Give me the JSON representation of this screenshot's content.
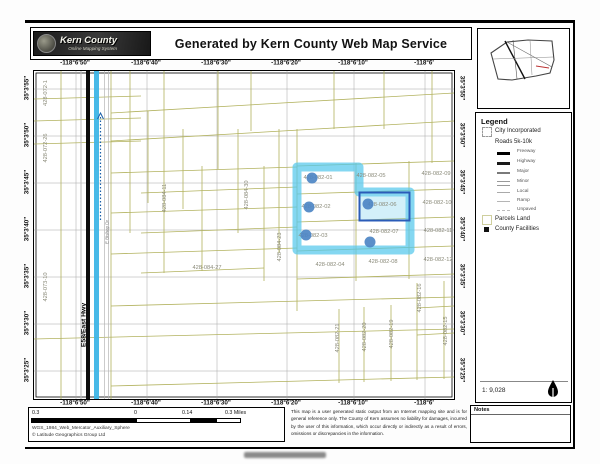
{
  "header": {
    "logo_title": "Kern County",
    "logo_subtitle": "Online Mapping System",
    "title": "Generated by Kern County Web Map Service"
  },
  "axes": {
    "top": [
      "-118°6'50\"",
      "-118°6'40\"",
      "-118°6'30\"",
      "-118°6'20\"",
      "-118°6'10\"",
      "-118°6'"
    ],
    "bottom": [
      "-118°6'50\"",
      "-118°6'40\"",
      "-118°6'30\"",
      "-118°6'20\"",
      "-118°6'10\"",
      "-118°6'"
    ],
    "left": [
      "35°3'55\"",
      "35°3'50\"",
      "35°3'45\"",
      "35°3'40\"",
      "35°3'35\"",
      "35°3'30\"",
      "35°3'25\""
    ],
    "right": [
      "35°3'55\"",
      "35°3'50\"",
      "35°3'45\"",
      "35°3'40\"",
      "35°3'35\"",
      "35°3'30\"",
      "35°3'25\""
    ]
  },
  "map": {
    "parcel_labels": [
      "428-082-01",
      "428-082-05",
      "428-082-09",
      "428-082-02",
      "428-082-06",
      "428-082-10",
      "428-082-03",
      "428-082-07",
      "428-082-11",
      "428-082-04",
      "428-082-08",
      "428-082-12",
      "428-084-27",
      "428-072-1",
      "428-072-26",
      "428-073-10",
      "428-084-11",
      "428-084-30",
      "428-084-23",
      "428-082-21",
      "428-082-20",
      "428-082-19",
      "428-082-16",
      "428-082-15"
    ],
    "highlighted_parcels": [
      "428-082-01",
      "428-082-02",
      "428-082-03",
      "428-082-06",
      "428-082-07"
    ],
    "road_labels": {
      "highway": "E58/East Hwy",
      "street": "E Bishop Dr"
    },
    "colors": {
      "parcel_line": "#b2b25e",
      "highlight": "#54c8ec",
      "selection_border": "#2b5cb8",
      "marker_dot": "#4d86c4"
    }
  },
  "legend": {
    "title": "Legend",
    "city_item": "City Incorporated",
    "roads_header": "Roads 5k-10k",
    "road_types": [
      "Freeway",
      "Highway",
      "Major",
      "Minor",
      "Local",
      "Ramp",
      "Unpaved"
    ],
    "parcels_item": "Parcels Land",
    "facilities_item": "County Facilities",
    "scale_ratio": "1: 9,028"
  },
  "scalebar": {
    "labels": [
      "0.3",
      "0",
      "0.14",
      "0.3 Miles"
    ],
    "projection": "WGS_1984_Web_Mercator_Auxiliary_Sphere",
    "copyright": "© Latitude Geographics Group Ltd"
  },
  "disclaimer": "This map is a user generated static output from an Internet mapping site and is for general reference only. The County of Kern assumes no liability for damages, incurred by the user of this information, which occur directly or indirectly as a result of errors, omissions or discrepancies in the information.",
  "notes": {
    "title": "Notes"
  }
}
